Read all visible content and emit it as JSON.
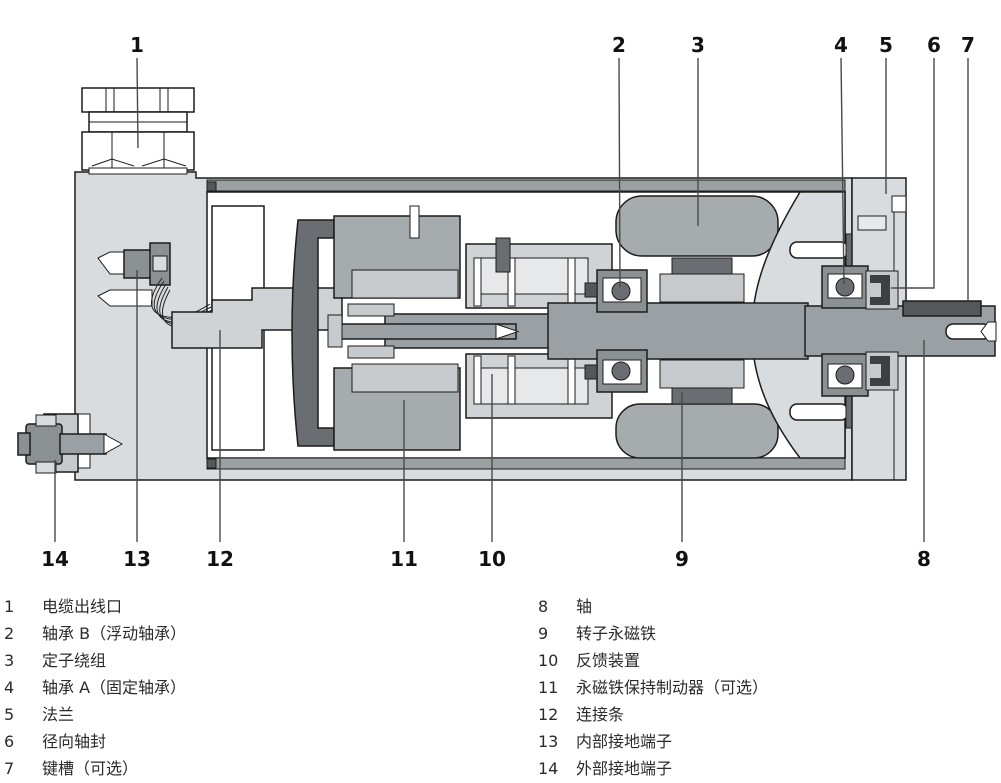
{
  "diagram": {
    "title": "servo-motor-cross-section",
    "top_callouts": [
      "1",
      "2",
      "3",
      "4",
      "5",
      "6",
      "7"
    ],
    "bottom_callouts": [
      "14",
      "13",
      "12",
      "11",
      "10",
      "9",
      "8"
    ]
  },
  "legend": {
    "left": [
      {
        "num": "1",
        "text": "电缆出线口"
      },
      {
        "num": "2",
        "text": "轴承 B（浮动轴承）"
      },
      {
        "num": "3",
        "text": "定子绕组"
      },
      {
        "num": "4",
        "text": "轴承 A（固定轴承）"
      },
      {
        "num": "5",
        "text": "法兰"
      },
      {
        "num": "6",
        "text": "径向轴封"
      },
      {
        "num": "7",
        "text": "键槽（可选）"
      }
    ],
    "right": [
      {
        "num": "8",
        "text": "轴"
      },
      {
        "num": "9",
        "text": "转子永磁铁"
      },
      {
        "num": "10",
        "text": "反馈装置"
      },
      {
        "num": "11",
        "text": "永磁铁保持制动器（可选）"
      },
      {
        "num": "12",
        "text": "连接条"
      },
      {
        "num": "13",
        "text": "内部接地端子"
      },
      {
        "num": "14",
        "text": "外部接地端子"
      }
    ]
  },
  "colors": {
    "background": "#ffffff",
    "outline": "#1c1c1c",
    "housing_light": "#d9dcde",
    "component_medium": "#a6abae",
    "component_dark": "#6a6e72",
    "component_darker": "#55585b",
    "shaft": "#9ba0a4",
    "leader_line": "#4a4a4a",
    "text": "#2b2b2b"
  }
}
